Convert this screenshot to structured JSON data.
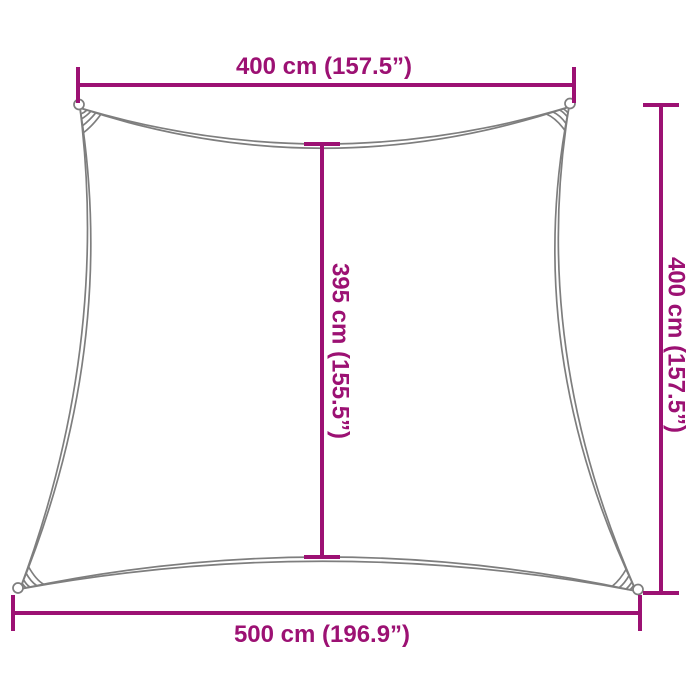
{
  "diagram": {
    "type": "product-dimension-diagram",
    "subject": "shade sail outline with concave edges and corner grommets",
    "unit_primary": "cm",
    "unit_secondary": "inches"
  },
  "colors": {
    "dimension": "#9C1173",
    "outline": "#7E7E7E",
    "background": "#FFFFFF"
  },
  "labels": {
    "top": "400 cm (157.5”)",
    "right": "400 cm (157.5”)",
    "center": "395 cm (155.5”)",
    "bottom": "500 cm (196.9”)"
  },
  "measurements": {
    "top_edge_cm": 400,
    "top_edge_in": 157.5,
    "right_edge_cm": 400,
    "right_edge_in": 157.5,
    "center_height_cm": 395,
    "center_height_in": 155.5,
    "bottom_edge_cm": 500,
    "bottom_edge_in": 196.9
  }
}
